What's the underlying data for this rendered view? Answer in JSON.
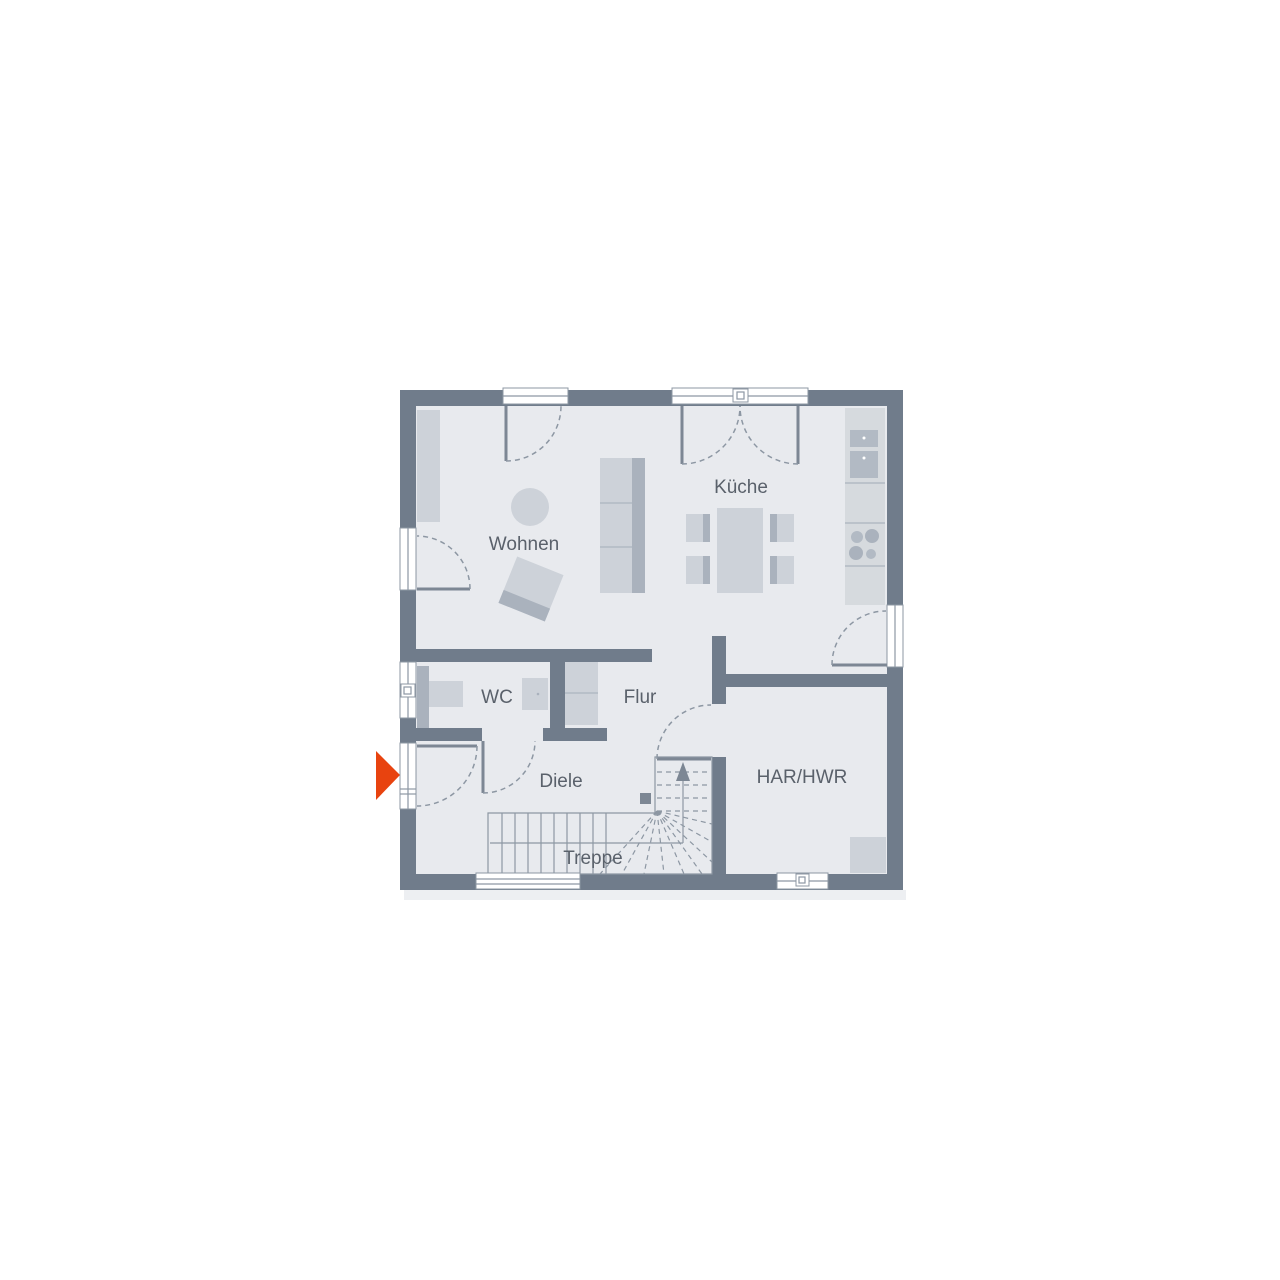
{
  "plan": {
    "type": "floor-plan",
    "rooms": [
      {
        "id": "wohnen",
        "label": "Wohnen"
      },
      {
        "id": "kueche",
        "label": "Küche"
      },
      {
        "id": "wc",
        "label": "WC"
      },
      {
        "id": "flur",
        "label": "Flur"
      },
      {
        "id": "diele",
        "label": "Diele"
      },
      {
        "id": "har-hwr",
        "label": "HAR/HWR"
      },
      {
        "id": "treppe",
        "label": "Treppe"
      }
    ],
    "entrance_marker": {
      "shape": "triangle",
      "direction": "right",
      "color": "#e8430f"
    },
    "stairs": {
      "direction_arrow": "up",
      "label": "Treppe"
    },
    "colors": {
      "wall": "#707c8b",
      "floor": "#e8eaee",
      "furniture_light": "#cdd2d9",
      "furniture_mid": "#aab2bd",
      "counter": "#d6dade",
      "appliance": "#b2bac4",
      "line": "#8d97a3",
      "leaf": "#7d8794",
      "text": "#5a616b",
      "accent": "#e8430f",
      "white": "#ffffff",
      "shadow": "#edeff2"
    }
  }
}
